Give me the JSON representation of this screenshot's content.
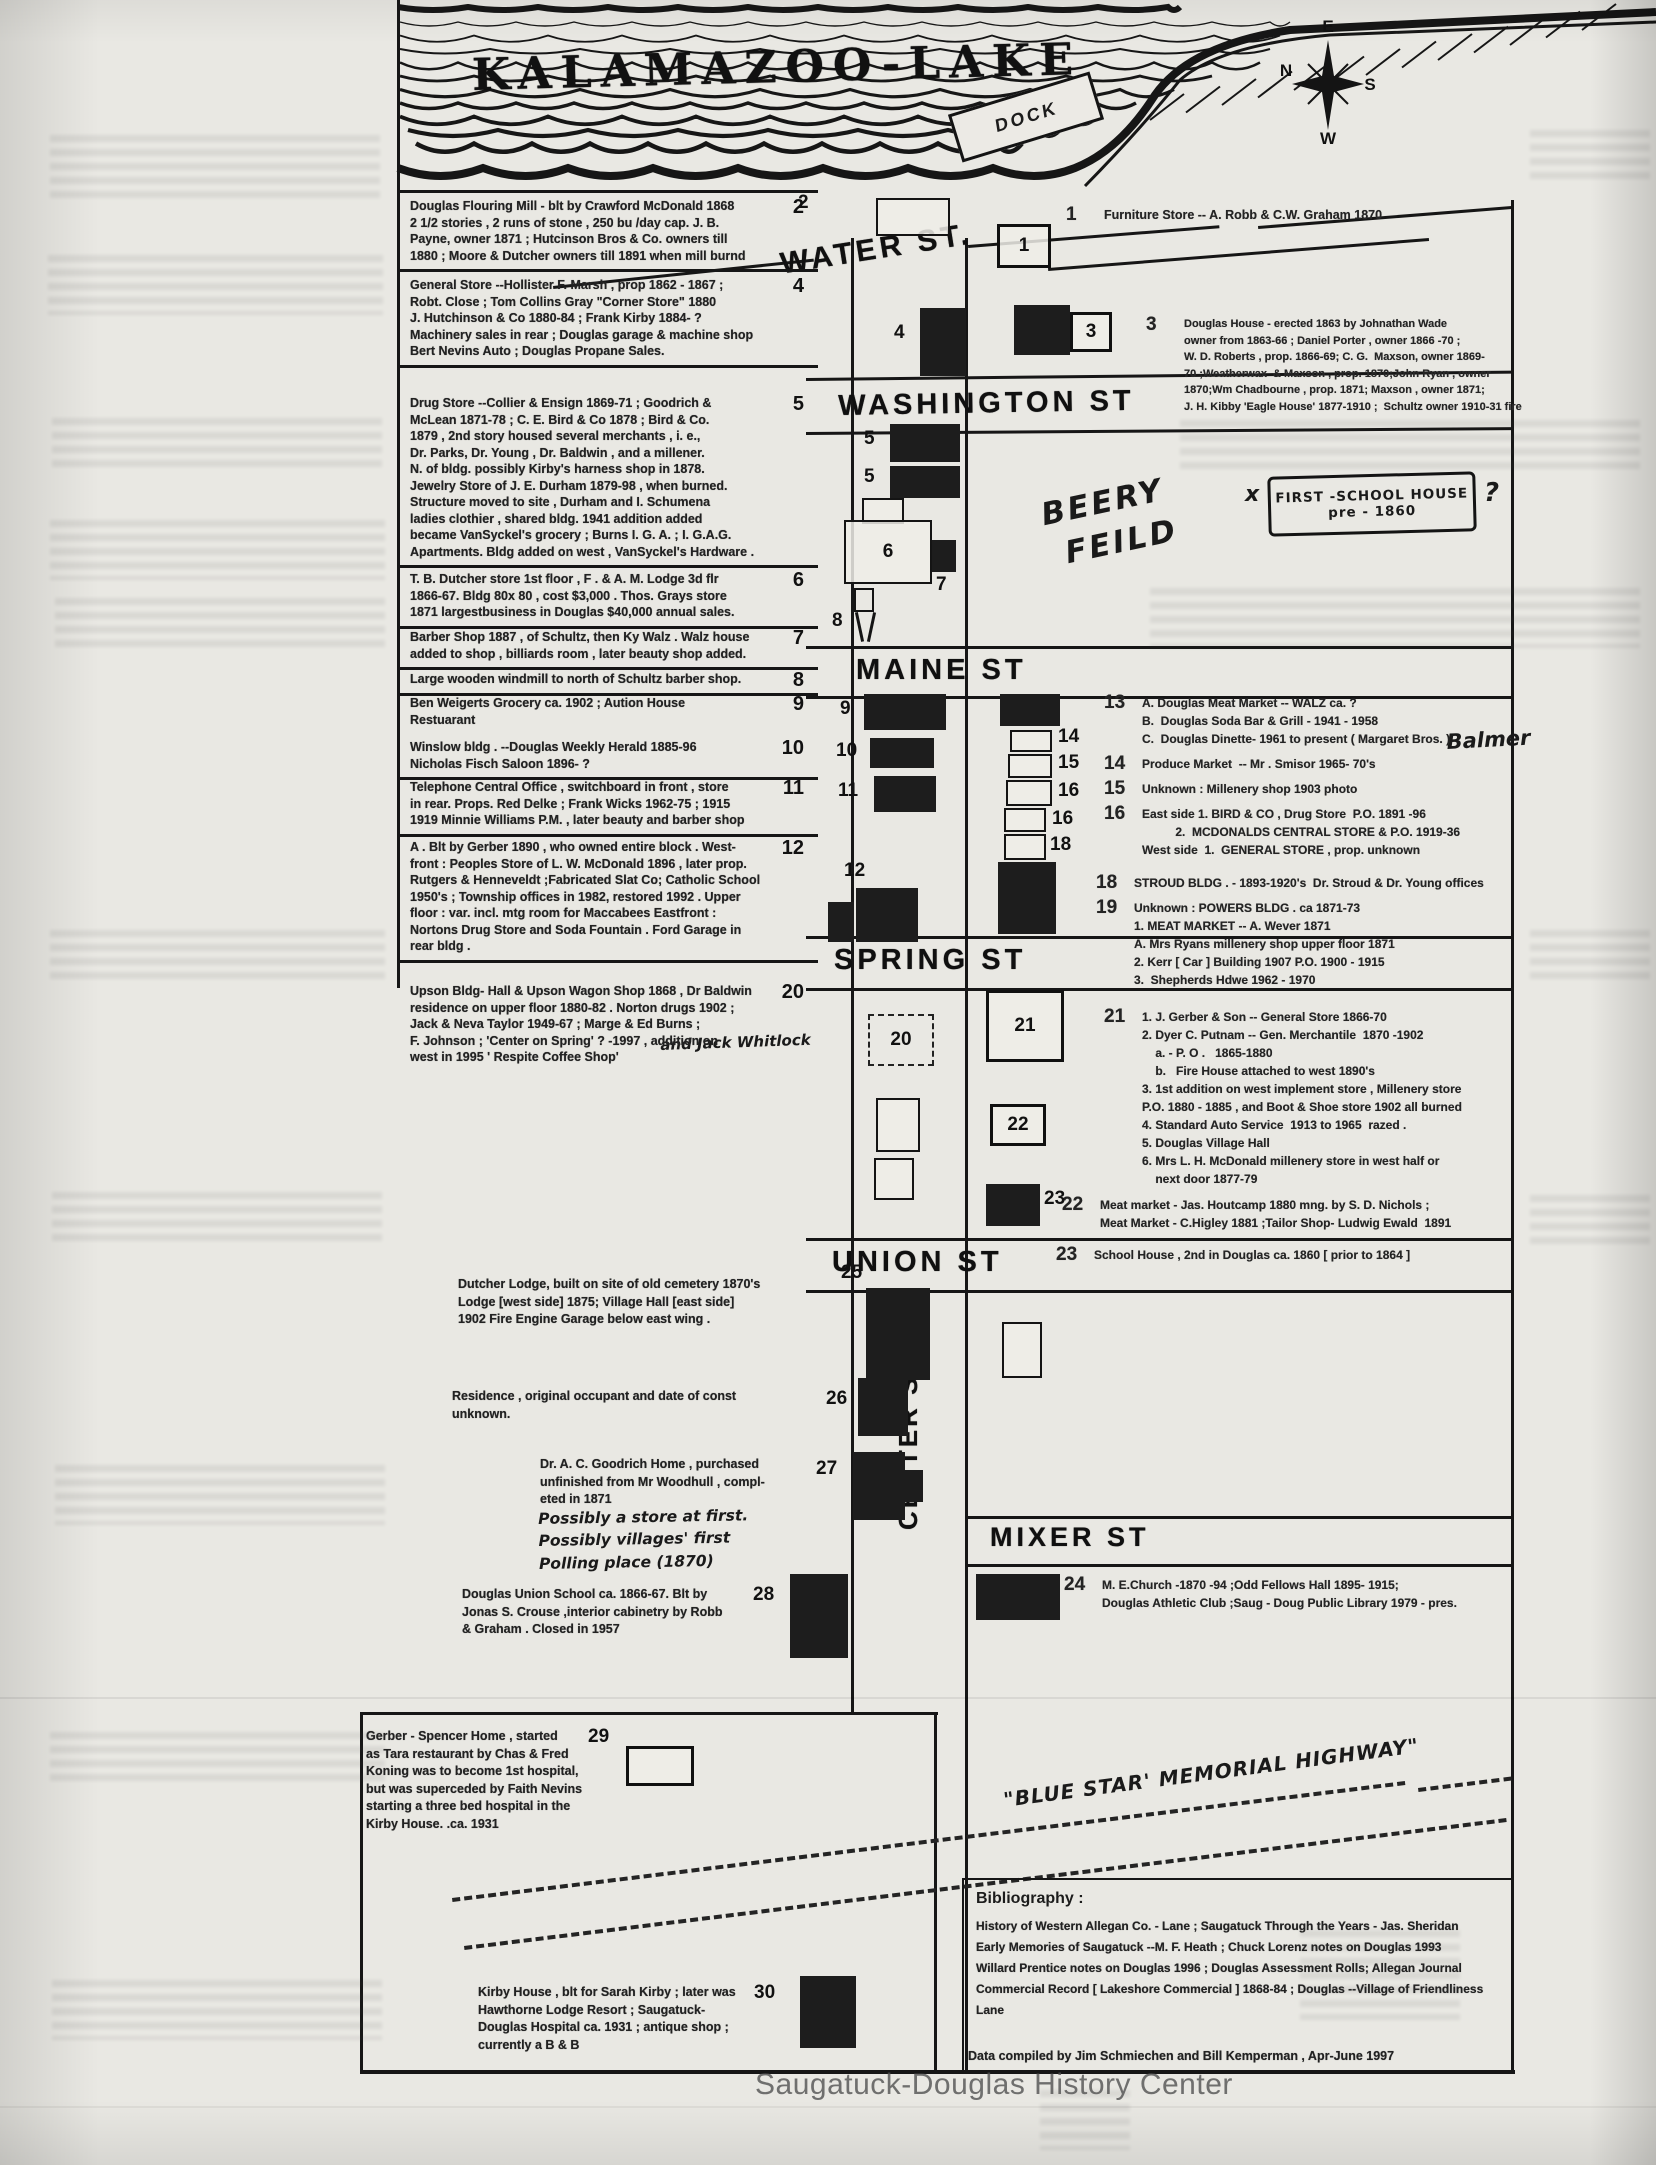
{
  "header": {
    "lake_title": "KALAMAZOO-LAKE",
    "dock": "DOCK",
    "compass": {
      "top": "E",
      "left": "N",
      "right": "S",
      "bottom": "W"
    }
  },
  "streets": {
    "water": "WATER ST.",
    "washington": "WASHINGTON ST",
    "maine": "MAINE ST",
    "spring": "SPRING  ST",
    "union": "UNION  ST",
    "mixer": "MIXER ST",
    "center": "CENTER ST"
  },
  "labels": {
    "beery1": "BEERY",
    "beery2": "FEILD",
    "x_mark": "x",
    "question_mark": "?",
    "first_school_line1": "FIRST -SCHOOL HOUSE",
    "first_school_line2": "pre - 1860",
    "blue_star": "\"BLUE STAR' MEMORIAL HIGHWAY\""
  },
  "left_blocks": [
    {
      "num": "2",
      "top": 193,
      "sep": true,
      "text": "Douglas Flouring Mill - blt by Crawford McDonald 1868\n2 1/2 stories , 2 runs of stone , 250 bu /day cap. J. B.\nPayne, owner 1871 ; Hutcinson Bros & Co. owners till\n1880 ; Moore & Dutcher owners till 1891 when mill burnd"
    },
    {
      "num": "4",
      "top": 272,
      "sep": true,
      "text": "General Store --Hollister F. Marsh , prop 1862 - 1867 ;\nRobt. Close ; Tom Collins Gray \"Corner Store\" 1880\nJ. Hutchinson & Co 1880-84 ; Frank Kirby 1884- ?\nMachinery sales in rear ; Douglas garage & machine shop\nBert Nevins Auto ; Douglas Propane Sales."
    },
    {
      "num": "5",
      "top": 390,
      "sep": true,
      "text": "Drug Store --Collier & Ensign 1869-71 ; Goodrich &\nMcLean 1871-78 ; C. E. Bird & Co 1878 ; Bird & Co.\n1879 , 2nd story housed several merchants , i. e.,\nDr. Parks, Dr. Young , Dr. Baldwin , and a millener.\nN. of  bldg. possibly  Kirby's harness shop in 1878.\nJewelry Store of J. E. Durham 1879-98 , when burned.\nStructure moved to site , Durham and I. Schumena\nladies clothier , shared bldg. 1941 addition added\nbecame VanSyckel's grocery ; Burns I. G. A. ; I. G.A.G.\nApartments. Bldg added on west , VanSyckel's Hardware ."
    },
    {
      "num": "6",
      "top": 566,
      "sep": true,
      "text": "T. B. Dutcher store 1st floor , F . & A. M. Lodge 3d flr\n1866-67. Bldg 80x 80 , cost $3,000 .  Thos. Grays store\n1871 largestbusiness in Douglas $40,000 annual sales."
    },
    {
      "num": "7",
      "top": 624,
      "sep": true,
      "text": "Barber Shop 1887 , of Schultz, then Ky Walz . Walz house\nadded to shop , billiards room , later beauty shop added."
    },
    {
      "num": "8",
      "top": 666,
      "sep": true,
      "text": "Large wooden windmill to north of Schultz barber shop."
    },
    {
      "num": "9",
      "top": 690,
      "sep": false,
      "text": "Ben Weigerts Grocery ca. 1902 ; Aution House\nRestuarant"
    },
    {
      "num": "10",
      "top": 734,
      "sep": true,
      "text": "Winslow bldg . --Douglas Weekly Herald 1885-96\nNicholas Fisch Saloon 1896- ?"
    },
    {
      "num": "11",
      "top": 774,
      "sep": true,
      "text": "Telephone Central Office , switchboard in front , store\nin rear. Props. Red Delke ; Frank Wicks 1962-75 ; 1915\n1919 Minnie Williams P.M. , later beauty and barber shop"
    },
    {
      "num": "12",
      "top": 834,
      "sep": true,
      "text": "A . Blt by Gerber 1890 , who owned entire block . West-\nfront :  Peoples Store of  L. W. McDonald 1896 , later prop.\nRutgers & Henneveldt ;Fabricated Slat Co; Catholic School\n1950's ; Township offices in 1982, restored 1992 . Upper\nfloor : var. incl. mtg room for Maccabees Eastfront :\nNortons Drug Store and Soda Fountain . Ford Garage in\nrear bldg ."
    },
    {
      "num": "20",
      "top": 978,
      "sep": false,
      "text": "Upson Bldg- Hall & Upson Wagon Shop 1868 , Dr Baldwin\nresidence on upper floor 1880-82 . Norton drugs 1902 ;\nJack &  Neva  Taylor 1949-67 ;  Marge & Ed  Burns ;\nF. Johnson ;  'Center on Spring'  ? -1997 , addition on\nwest in 1995 ' Respite Coffee Shop'"
    }
  ],
  "standalone_notes": [
    {
      "x": 458,
      "y": 1276,
      "w": 350,
      "text": "Dutcher Lodge, built on site of old cemetery 1870's\nLodge [west side] 1875; Village Hall [east side]\n1902     Fire Engine Garage below east wing ."
    },
    {
      "x": 452,
      "y": 1388,
      "w": 340,
      "text": "Residence , original occupant and date of const\nunknown."
    },
    {
      "x": 540,
      "y": 1456,
      "w": 290,
      "text": "Dr. A. C. Goodrich Home , purchased\nunfinished from Mr Woodhull , compl-\neted in 1871"
    },
    {
      "x": 462,
      "y": 1586,
      "w": 300,
      "text": "Douglas  Union School ca. 1866-67. Blt  by\nJonas S. Crouse ,interior cabinetry by Robb\n& Graham . Closed in 1957"
    },
    {
      "x": 366,
      "y": 1728,
      "w": 240,
      "text": "Gerber - Spencer Home , started\nas Tara restaurant by Chas & Fred\nKoning was to become 1st hospital,\nbut was superceded by Faith Nevins\nstarting a three bed  hospital in the\nKirby House. .ca. 1931"
    },
    {
      "x": 478,
      "y": 1984,
      "w": 310,
      "text": "Kirby House , blt for Sarah Kirby ; later was\nHawthorne  Lodge Resort ;  Saugatuck-\nDouglas Hospital ca. 1931 ; antique shop ;\ncurrently a B & B"
    }
  ],
  "note_groups": [
    {
      "x": 1066,
      "y": 206,
      "size": 12.5,
      "entries": [
        {
          "num": "1",
          "lines": "Furniture Store -- A. Robb & C.W. Graham 1870"
        }
      ]
    },
    {
      "x": 1146,
      "y": 316,
      "size": 11,
      "entries": [
        {
          "num": "3",
          "lines": "Douglas House - erected 1863 by Johnathan Wade\nowner from 1863-66 ; Daniel Porter , owner 1866 -70 ;\nW. D. Roberts , prop. 1866-69; C. G.  Maxson, owner 1869-\n70 ;Weatherwax  & Maxson , prop. 1870;John Ryan , owner\n1870;Wm Chadbourne , prop. 1871; Maxson , owner 1871;\nJ. H. Kibby 'Eagle House' 1877-1910 ;  Schultz owner 1910-31 fire"
        }
      ]
    },
    {
      "x": 1104,
      "y": 694,
      "size": 12,
      "entries": [
        {
          "num": "13",
          "lines": "A. Douglas Meat Market -- WALZ ca. ?\nB.  Douglas Soda Bar & Grill - 1941 - 1958\nC.  Douglas Dinette- 1961 to present ( Margaret Bros. )"
        },
        {
          "num": "14",
          "lines": "Produce Market  -- Mr . Smisor 1965- 70's"
        },
        {
          "num": "15",
          "lines": "Unknown : Millenery shop 1903 photo"
        },
        {
          "num": "16",
          "lines": "East side 1. BIRD & CO , Drug Store  P.O. 1891 -96\n          2.  MCDONALDS CENTRAL STORE & P.O. 1919-36\nWest side  1.  GENERAL STORE , prop. unknown"
        }
      ]
    },
    {
      "x": 1096,
      "y": 874,
      "size": 12,
      "entries": [
        {
          "num": "18",
          "lines": "STROUD BLDG . - 1893-1920's  Dr. Stroud & Dr. Young offices"
        },
        {
          "num": "19",
          "lines": "Unknown : POWERS BLDG . ca 1871-73\n1. MEAT MARKET -- A. Wever 1871\nA. Mrs Ryans millenery shop upper floor 1871\n2. Kerr [ Car ] Building 1907 P.O. 1900 - 1915\n3.  Shepherds Hdwe 1962 - 1970"
        }
      ]
    },
    {
      "x": 1104,
      "y": 1008,
      "size": 12,
      "entries": [
        {
          "num": "21",
          "lines": "1. J. Gerber & Son -- General Store 1866-70\n2. Dyer C. Putnam -- Gen. Merchantile  1870 -1902\n    a. - P. O .   1865-1880\n    b.   Fire House attached to west 1890's\n3. 1st addition on west implement store , Millenery store\nP.O. 1880 - 1885 , and Boot & Shoe store 1902 all burned\n4. Standard Auto Service  1913 to 1965  razed .\n5. Douglas Village Hall\n6. Mrs L. H. McDonald millenery store in west half or\n    next door 1877-79"
        }
      ]
    },
    {
      "x": 1062,
      "y": 1196,
      "size": 12,
      "entries": [
        {
          "num": "22",
          "lines": "Meat market - Jas. Houtcamp 1880 mng. by S. D. Nichols ;\nMeat Market - C.Higley 1881 ;Tailor Shop- Ludwig Ewald  1891"
        }
      ]
    },
    {
      "x": 1056,
      "y": 1246,
      "size": 12,
      "entries": [
        {
          "num": "23",
          "lines": "School House , 2nd in Douglas ca. 1860 [ prior to 1864 ]"
        }
      ]
    },
    {
      "x": 1064,
      "y": 1576,
      "size": 12,
      "entries": [
        {
          "num": "24",
          "lines": "M. E.Church -1870 -94 ;Odd Fellows Hall 1895- 1915;\nDouglas Athletic Club ;Saug - Doug Public Library 1979 - pres."
        }
      ]
    }
  ],
  "handwritten": {
    "balmer": "Balmer",
    "jack_whitlock": "and  Jack  Whitlock",
    "possibly": "Possibly a store at first.\nPossibly villages' first\n    Polling place (1870)"
  },
  "map": {
    "buildings": [
      {
        "label": "2",
        "x": 876,
        "y": 198,
        "w": 74,
        "h": 38,
        "fill": "open",
        "nx": 798,
        "ny": 192
      },
      {
        "label": "1",
        "x": 997,
        "y": 224,
        "w": 54,
        "h": 44,
        "fill": "open-thick",
        "inside": true
      },
      {
        "label": "4",
        "x": 920,
        "y": 308,
        "w": 46,
        "h": 68,
        "fill": "dark",
        "nx": 894,
        "ny": 322
      },
      {
        "label": "",
        "x": 1014,
        "y": 305,
        "w": 56,
        "h": 50,
        "fill": "dark"
      },
      {
        "label": "3",
        "x": 1070,
        "y": 312,
        "w": 42,
        "h": 40,
        "fill": "open-thick",
        "inside": true
      },
      {
        "label": "5",
        "x": 890,
        "y": 424,
        "w": 70,
        "h": 38,
        "fill": "dark",
        "nx": 864,
        "ny": 428
      },
      {
        "label": "5",
        "x": 890,
        "y": 466,
        "w": 70,
        "h": 32,
        "fill": "dark",
        "nx": 864,
        "ny": 466
      },
      {
        "label": "",
        "x": 862,
        "y": 498,
        "w": 42,
        "h": 26,
        "fill": "open"
      },
      {
        "label": "6",
        "x": 844,
        "y": 520,
        "w": 88,
        "h": 64,
        "fill": "open",
        "inside": true
      },
      {
        "label": "7",
        "x": 932,
        "y": 540,
        "w": 24,
        "h": 32,
        "fill": "dark",
        "nx": 936,
        "ny": 574
      },
      {
        "label": "8",
        "x": 854,
        "y": 588,
        "w": 24,
        "h": 56,
        "fill": "windmill",
        "nx": 832,
        "ny": 610
      },
      {
        "label": "9",
        "x": 864,
        "y": 694,
        "w": 82,
        "h": 36,
        "fill": "dark",
        "nx": 840,
        "ny": 698
      },
      {
        "label": "10",
        "x": 870,
        "y": 738,
        "w": 64,
        "h": 30,
        "fill": "dark",
        "nx": 836,
        "ny": 740
      },
      {
        "label": "11",
        "x": 874,
        "y": 776,
        "w": 62,
        "h": 36,
        "fill": "dark",
        "nx": 838,
        "ny": 780
      },
      {
        "label": "12",
        "x": 856,
        "y": 888,
        "w": 62,
        "h": 54,
        "fill": "dark",
        "nx": 844,
        "ny": 860
      },
      {
        "label": "",
        "x": 828,
        "y": 902,
        "w": 26,
        "h": 40,
        "fill": "dark"
      },
      {
        "label": "13",
        "x": 1000,
        "y": 694,
        "w": 60,
        "h": 32,
        "fill": "dark"
      },
      {
        "label": "14",
        "x": 1010,
        "y": 730,
        "w": 42,
        "h": 22,
        "fill": "open",
        "nx": 1058,
        "ny": 726
      },
      {
        "label": "15",
        "x": 1008,
        "y": 754,
        "w": 44,
        "h": 24,
        "fill": "open",
        "nx": 1058,
        "ny": 752
      },
      {
        "label": "16",
        "x": 1006,
        "y": 780,
        "w": 46,
        "h": 26,
        "fill": "open",
        "nx": 1058,
        "ny": 780
      },
      {
        "label": "16",
        "x": 1004,
        "y": 808,
        "w": 42,
        "h": 24,
        "fill": "open",
        "nx": 1052,
        "ny": 808
      },
      {
        "label": "18",
        "x": 1004,
        "y": 834,
        "w": 42,
        "h": 26,
        "fill": "open",
        "nx": 1050,
        "ny": 834
      },
      {
        "label": "19",
        "x": 998,
        "y": 862,
        "w": 58,
        "h": 72,
        "fill": "dark"
      },
      {
        "label": "20",
        "x": 868,
        "y": 1014,
        "w": 66,
        "h": 52,
        "fill": "dashed",
        "inside": true
      },
      {
        "label": "21",
        "x": 986,
        "y": 990,
        "w": 78,
        "h": 72,
        "fill": "open-thick",
        "inside": true
      },
      {
        "label": "",
        "x": 876,
        "y": 1098,
        "w": 44,
        "h": 54,
        "fill": "open"
      },
      {
        "label": "22",
        "x": 990,
        "y": 1104,
        "w": 56,
        "h": 42,
        "fill": "open-thick",
        "inside": true
      },
      {
        "label": "",
        "x": 874,
        "y": 1158,
        "w": 40,
        "h": 42,
        "fill": "open"
      },
      {
        "label": "23",
        "x": 986,
        "y": 1184,
        "w": 54,
        "h": 42,
        "fill": "dark",
        "nx": 1044,
        "ny": 1188
      },
      {
        "label": "25",
        "x": 866,
        "y": 1288,
        "w": 64,
        "h": 92,
        "fill": "dark",
        "nx": 841,
        "ny": 1262
      },
      {
        "label": "",
        "x": 1002,
        "y": 1322,
        "w": 40,
        "h": 56,
        "fill": "open"
      },
      {
        "label": "26",
        "x": 858,
        "y": 1378,
        "w": 50,
        "h": 58,
        "fill": "dark",
        "nx": 826,
        "ny": 1388
      },
      {
        "label": "27",
        "x": 853,
        "y": 1452,
        "w": 52,
        "h": 68,
        "fill": "dark",
        "nx": 816,
        "ny": 1458
      },
      {
        "label": "",
        "x": 903,
        "y": 1470,
        "w": 20,
        "h": 32,
        "fill": "dark"
      },
      {
        "label": "28",
        "x": 790,
        "y": 1574,
        "w": 58,
        "h": 84,
        "fill": "dark",
        "nx": 753,
        "ny": 1584
      },
      {
        "label": "",
        "x": 976,
        "y": 1574,
        "w": 84,
        "h": 46,
        "fill": "dark"
      },
      {
        "label": "29",
        "x": 626,
        "y": 1746,
        "w": 68,
        "h": 40,
        "fill": "open-thick",
        "nx": 588,
        "ny": 1726
      },
      {
        "label": "30",
        "x": 800,
        "y": 1976,
        "w": 56,
        "h": 72,
        "fill": "dark",
        "nx": 754,
        "ny": 1982
      }
    ]
  },
  "bibliography": {
    "heading": "Bibliography :",
    "body": "History of Western Allegan Co. - Lane ;  Saugatuck Through the Years - Jas. Sheridan\nEarly  Memories of Saugatuck --M. F.  Heath  ;   Chuck Lorenz notes on Douglas 1993\nWillard Prentice notes on Douglas 1996 ; Douglas Assessment Rolls; Allegan Journal\nCommercial Record [ Lakeshore Commercial ] 1868-84 ; Douglas --Village of Friendliness\nLane",
    "credit": "Data compiled  by Jim Schmiechen and Bill Kemperman ,  Apr-June 1997"
  },
  "watermark": "Saugatuck-Douglas History Center"
}
